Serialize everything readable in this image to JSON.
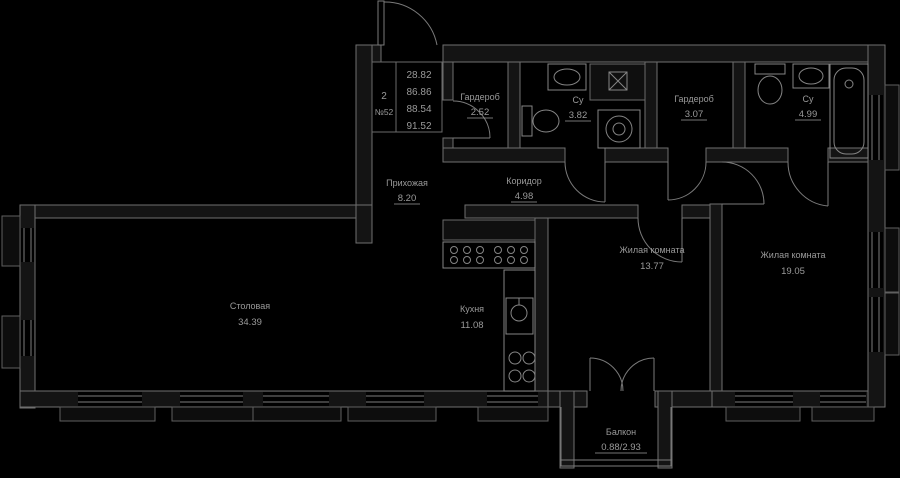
{
  "plan": {
    "type": "apartment-floor-plan",
    "info_box": {
      "rooms_count": "2",
      "apartment_number": "№52",
      "area_values": [
        "28.82",
        "86.86",
        "88.54",
        "91.52"
      ]
    },
    "rooms": {
      "wardrobe1": {
        "name": "Гардероб",
        "area": "2.52"
      },
      "bathroom1": {
        "name": "Су",
        "area": "3.82"
      },
      "wardrobe2": {
        "name": "Гардероб",
        "area": "3.07"
      },
      "bathroom2": {
        "name": "Су",
        "area": "4.99"
      },
      "hallway": {
        "name": "Прихожая",
        "area": "8.20"
      },
      "corridor": {
        "name": "Коридор",
        "area": "4.98"
      },
      "dining": {
        "name": "Столовая",
        "area": "34.39"
      },
      "kitchen": {
        "name": "Кухня",
        "area": "11.08"
      },
      "bedroom1": {
        "name": "Жилая комната",
        "area": "13.77"
      },
      "bedroom2": {
        "name": "Жилая комната",
        "area": "19.05"
      },
      "balcony": {
        "name": "Балкон",
        "area": "0.88/2.93"
      }
    },
    "colors": {
      "background": "#000000",
      "wall_line": "#6f6f6f",
      "text": "#9a9a9a",
      "fixture_line": "#858585"
    }
  }
}
